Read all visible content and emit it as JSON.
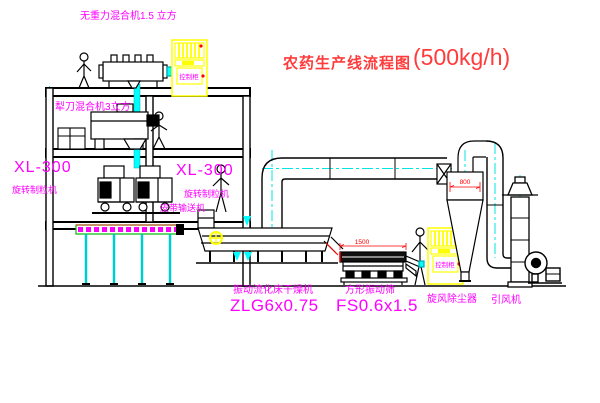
{
  "title": {
    "name": "农药生产线流程图",
    "capacity": "(500kg/h)"
  },
  "labels": {
    "top_mixer": "无重力混合机1.5 立方",
    "floor2_mixer": "犁刀混合机3立方",
    "granulator1_model": "XL-300",
    "granulator1_name": "旋转制粒机",
    "granulator2_model": "XL-300",
    "granulator2_name": "旋转制粒机",
    "belt_conveyor": "皮带输送机",
    "dryer_name": "振动流化床干燥机",
    "dryer_model": "ZLG6x0.75",
    "screen_name": "方形振动筛",
    "screen_model": "FS0.6x1.5",
    "cyclone": "旋风除尘器",
    "fan": "引风机",
    "control_cabinet": "控制柜"
  },
  "dimensions": {
    "screen_length": "1500",
    "cyclone_diameter": "800"
  },
  "colors": {
    "label_magenta": "#ff00ff",
    "title_red": "#ff3b3b",
    "dimension_red": "#ff0000",
    "equipment_yellow": "#ffff00",
    "centerline_cyan": "#00e5e5",
    "pipe_cyan": "#00ffff",
    "conveyor_green": "#00bb00",
    "linework": "#000000",
    "background": "#ffffff"
  }
}
